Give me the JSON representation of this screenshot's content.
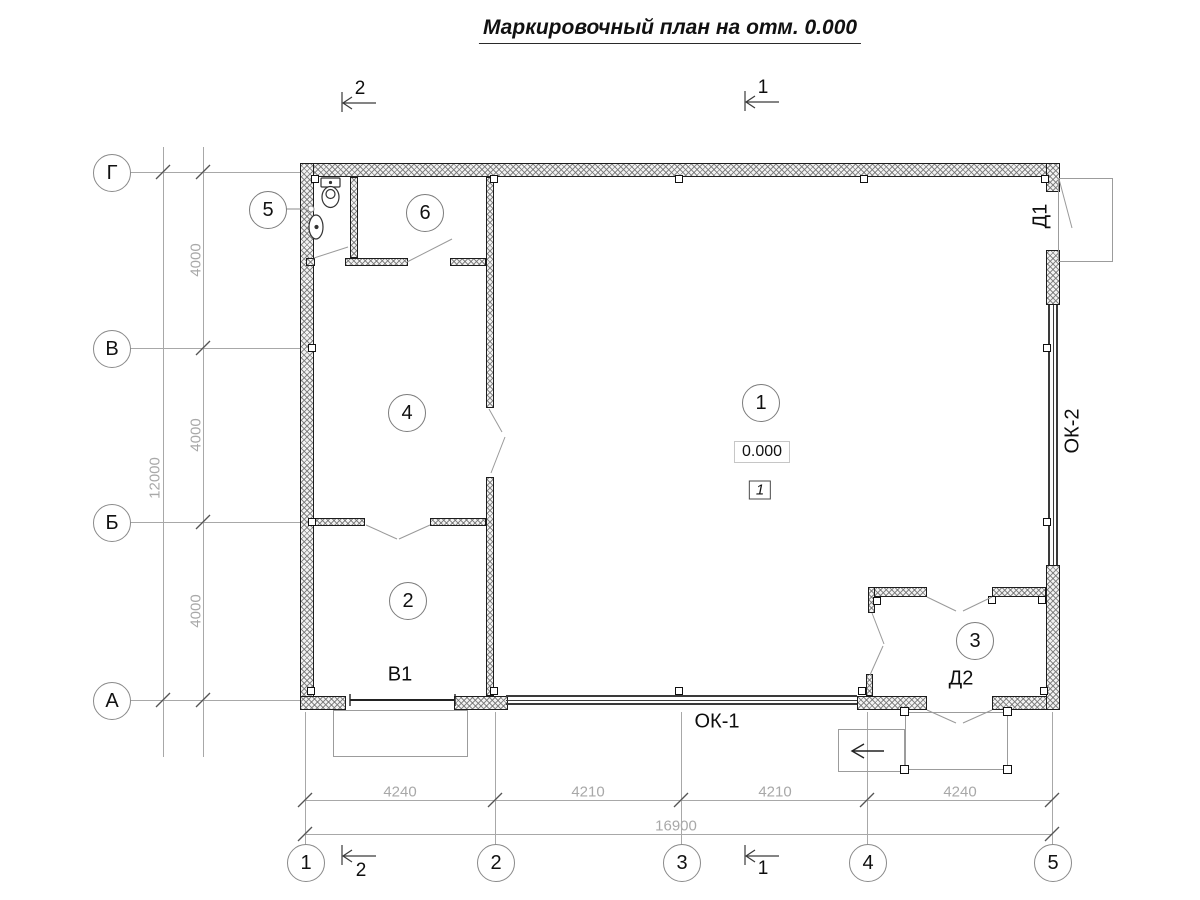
{
  "title": "Маркировочный план на отм. 0.000",
  "axes": {
    "rows": [
      "Г",
      "В",
      "Б",
      "А"
    ],
    "cols": [
      "1",
      "2",
      "3",
      "4",
      "5"
    ]
  },
  "dims": {
    "left_segments": [
      "4000",
      "4000",
      "4000"
    ],
    "left_total": "12000",
    "bottom_segments": [
      "4240",
      "4210",
      "4210",
      "4240"
    ],
    "bottom_total": "16900"
  },
  "sections": {
    "cut1": "1",
    "cut2": "2"
  },
  "rooms": [
    "1",
    "2",
    "3",
    "4",
    "5",
    "6"
  ],
  "marks": {
    "elevation": "0.000",
    "detail": "1",
    "gate": "В1",
    "window1": "ОК-1",
    "window2": "ОК-2",
    "door1": "Д1",
    "door2": "Д2"
  },
  "colors": {
    "line": "#1a1a1a",
    "dim_text": "#a8a8a8",
    "hatch": "#8f8f8f",
    "thin_line": "#9a9a9a",
    "background": "#ffffff"
  }
}
